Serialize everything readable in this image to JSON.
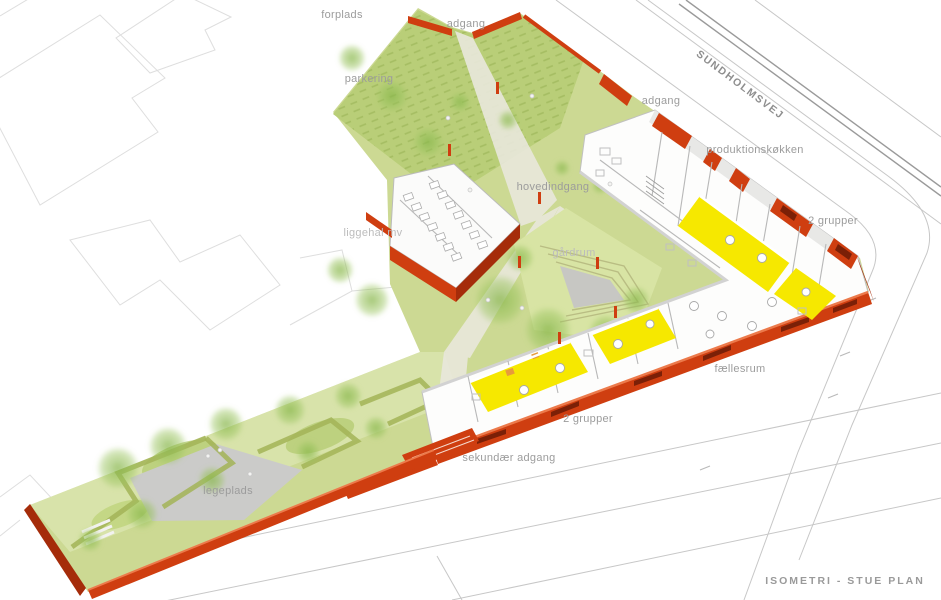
{
  "title": "ISOMETRI - STUE PLAN",
  "street": {
    "name": "SUNDHOLMSVEJ"
  },
  "labels": {
    "forplads": "forplads",
    "adgang_nw": "adgang",
    "parkering": "parkering",
    "adgang_ne": "adgang",
    "produktionskoekken": "produktionskøkken",
    "grupper_ne": "2 grupper",
    "hovedindgang": "hovedindgang",
    "liggehal": "liggehal mv",
    "gaardrum": "gårdrum",
    "faellesrum": "fællesrum",
    "grupper_s": "2 grupper",
    "sekundaer_adgang": "sekundær adgang",
    "legeplads": "legeplads"
  },
  "caption": "ISOMETRI - STUE PLAN",
  "colors": {
    "wall_red": "#cf3e10",
    "wall_red_dark": "#a52c0a",
    "wall_red_top": "#ec7a4b",
    "window_slot": "#7b2007",
    "room_yellow": "#f6e800",
    "accent_orange": "#e79b3c",
    "grass": "#ccd993",
    "grass_dark": "#b9ce78",
    "grass_light": "#dde7b4",
    "courtyard_green": "#d8e4a4",
    "hedge": "#a3b457",
    "plaza": "#cbcbc9",
    "path": "#e9e8dc",
    "road_line": "#c7c7c7",
    "road_dark": "#9a9a9a",
    "outline_faint": "#dedede",
    "label_gray": "#9c9c9c",
    "label_faint": "#bcbcbc",
    "building_white": "#fdfdfc"
  }
}
